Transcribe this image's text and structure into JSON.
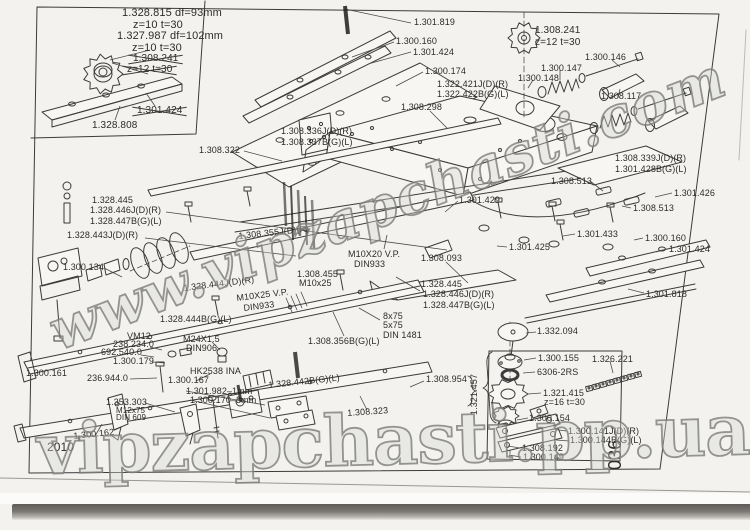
{
  "watermarks": {
    "diagonal": "www.vipzapchasti.com",
    "bottom": "vipzapchasti.pp.ua"
  },
  "labels": [
    {
      "text": "1.328.815  df=93mm",
      "x": 122,
      "y": 8,
      "fs": 11
    },
    {
      "text": "z=10 t=30",
      "x": 133,
      "y": 20,
      "fs": 11
    },
    {
      "text": "1.327.987  df=102mm",
      "x": 117,
      "y": 31,
      "fs": 11
    },
    {
      "text": "z=10 t=30",
      "x": 132,
      "y": 43,
      "fs": 11
    },
    {
      "text": "1.308.241",
      "x": 133,
      "y": 54,
      "fs": 10,
      "strike": true
    },
    {
      "text": "z=12 t=30",
      "x": 127,
      "y": 65,
      "fs": 10,
      "strike": true
    },
    {
      "text": "1.301.424",
      "x": 137,
      "y": 106,
      "fs": 10,
      "strike": true
    },
    {
      "text": "1.328.808",
      "x": 92,
      "y": 121,
      "fs": 10
    },
    {
      "text": "1.301.819",
      "x": 414,
      "y": 18
    },
    {
      "text": "1.300.160",
      "x": 396,
      "y": 37
    },
    {
      "text": "1.301.424",
      "x": 413,
      "y": 48
    },
    {
      "text": "1.300.174",
      "x": 425,
      "y": 67
    },
    {
      "text": "1.322.421J(D)(R)",
      "x": 437,
      "y": 80
    },
    {
      "text": "1.322.422B(G)(L)",
      "x": 437,
      "y": 90
    },
    {
      "text": "1.308.298",
      "x": 401,
      "y": 103
    },
    {
      "text": "1.308.336J(D)(R)",
      "x": 281,
      "y": 127
    },
    {
      "text": "1.308.337B(G)(L)",
      "x": 281,
      "y": 138
    },
    {
      "text": "1.308.241",
      "x": 535,
      "y": 26,
      "fs": 10
    },
    {
      "text": "z=12 t=30",
      "x": 535,
      "y": 38,
      "fs": 10
    },
    {
      "text": "1.300.146",
      "x": 585,
      "y": 53
    },
    {
      "text": "1.300.147",
      "x": 541,
      "y": 64
    },
    {
      "text": "1.300.148",
      "x": 518,
      "y": 74
    },
    {
      "text": "1.308.117",
      "x": 601,
      "y": 92
    },
    {
      "text": "1.308.322",
      "x": 199,
      "y": 146
    },
    {
      "text": "1.328.445",
      "x": 92,
      "y": 196
    },
    {
      "text": "1.328.446J(D)(R)",
      "x": 90,
      "y": 206
    },
    {
      "text": "1.328.447B(G)(L)",
      "x": 90,
      "y": 217
    },
    {
      "text": "1.328.443J(D)(R)",
      "x": 67,
      "y": 231
    },
    {
      "text": "1.300.134",
      "x": 63,
      "y": 263
    },
    {
      "text": "1.308.355J(D)(R)",
      "x": 238,
      "y": 232,
      "rot": -6
    },
    {
      "text": "M10X20 V.P.",
      "x": 348,
      "y": 250
    },
    {
      "text": "DIN933",
      "x": 354,
      "y": 260
    },
    {
      "text": "1.308.093",
      "x": 421,
      "y": 254
    },
    {
      "text": "1.301.429",
      "x": 459,
      "y": 196
    },
    {
      "text": "1.308.339J(D)(R)",
      "x": 615,
      "y": 154
    },
    {
      "text": "1.301.428B(G)(L)",
      "x": 615,
      "y": 165
    },
    {
      "text": "1.308.513",
      "x": 551,
      "y": 177
    },
    {
      "text": "1.301.426",
      "x": 674,
      "y": 189
    },
    {
      "text": "1.308.513",
      "x": 633,
      "y": 204
    },
    {
      "text": "1.301.433",
      "x": 577,
      "y": 230
    },
    {
      "text": "1.301.425",
      "x": 509,
      "y": 243
    },
    {
      "text": "1.300.160",
      "x": 645,
      "y": 234
    },
    {
      "text": "1.301.424",
      "x": 669,
      "y": 245
    },
    {
      "text": "1.301.818",
      "x": 646,
      "y": 290
    },
    {
      "text": "1.328.445",
      "x": 421,
      "y": 280
    },
    {
      "text": "1.328.446J(D)(R)",
      "x": 423,
      "y": 290
    },
    {
      "text": "1.328.447B(G)(L)",
      "x": 423,
      "y": 301
    },
    {
      "text": "8x75",
      "x": 383,
      "y": 312
    },
    {
      "text": "5x75",
      "x": 383,
      "y": 321
    },
    {
      "text": "DIN 1481",
      "x": 383,
      "y": 331
    },
    {
      "text": "1.308.356B(G)(L)",
      "x": 308,
      "y": 337
    },
    {
      "text": "1.308.455",
      "x": 297,
      "y": 270
    },
    {
      "text": "M10x25",
      "x": 299,
      "y": 279
    },
    {
      "text": "1.328.444J(D)(R)",
      "x": 183,
      "y": 284,
      "rot": -7
    },
    {
      "text": "M10X25 V.P.",
      "x": 236,
      "y": 294,
      "rot": -7
    },
    {
      "text": "DIN933",
      "x": 243,
      "y": 304,
      "rot": -7
    },
    {
      "text": "1.328.444B(G)(L)",
      "x": 160,
      "y": 315
    },
    {
      "text": "M24X1.5",
      "x": 183,
      "y": 335
    },
    {
      "text": "DIN906",
      "x": 186,
      "y": 344
    },
    {
      "text": "VM12",
      "x": 127,
      "y": 332
    },
    {
      "text": "238.234.0",
      "x": 113,
      "y": 340
    },
    {
      "text": "692.540.0",
      "x": 101,
      "y": 348
    },
    {
      "text": "1.300.179",
      "x": 113,
      "y": 357
    },
    {
      "text": "1.300.161",
      "x": 26,
      "y": 369
    },
    {
      "text": "236.944.0",
      "x": 87,
      "y": 374
    },
    {
      "text": "HK2538 INA",
      "x": 190,
      "y": 367
    },
    {
      "text": "1.300.167",
      "x": 168,
      "y": 376
    },
    {
      "text": "1.301.982–1mm",
      "x": 186,
      "y": 387
    },
    {
      "text": "1.300.170–3mm",
      "x": 190,
      "y": 396
    },
    {
      "text": "1.353.303",
      "x": 106,
      "y": 398
    },
    {
      "text": "M12x75",
      "x": 116,
      "y": 407,
      "fs": 8
    },
    {
      "text": "DIN 609",
      "x": 116,
      "y": 414,
      "fs": 8
    },
    {
      "text": "1.300.162",
      "x": 73,
      "y": 432,
      "rot": -6
    },
    {
      "text": "2010",
      "x": 47,
      "y": 441,
      "fs": 12
    },
    {
      "text": "1.328.442B(G)(L)",
      "x": 268,
      "y": 381,
      "rot": -6
    },
    {
      "text": "1.308.323",
      "x": 347,
      "y": 409,
      "rot": -4
    },
    {
      "text": "1.308.954",
      "x": 426,
      "y": 375
    },
    {
      "text": "1.321.457",
      "x": 470,
      "y": 415,
      "rot": -90
    },
    {
      "text": "1.332.094",
      "x": 537,
      "y": 327
    },
    {
      "text": "1.300.155",
      "x": 538,
      "y": 354
    },
    {
      "text": "6306-2RS",
      "x": 537,
      "y": 368
    },
    {
      "text": "1.326.221",
      "x": 592,
      "y": 355
    },
    {
      "text": "1.321.415",
      "x": 543,
      "y": 389
    },
    {
      "text": "z=16 t=30",
      "x": 544,
      "y": 398
    },
    {
      "text": "1.300.154",
      "x": 529,
      "y": 414
    },
    {
      "text": "1.300.141J(D)(R)",
      "x": 568,
      "y": 427
    },
    {
      "text": "1.300.144B(G)(L)",
      "x": 570,
      "y": 436
    },
    {
      "text": "1.308.192",
      "x": 522,
      "y": 444
    },
    {
      "text": "1.300.149",
      "x": 523,
      "y": 453
    },
    {
      "text": "036",
      "x": 606,
      "y": 470,
      "rot": -90,
      "fs": 18
    }
  ]
}
